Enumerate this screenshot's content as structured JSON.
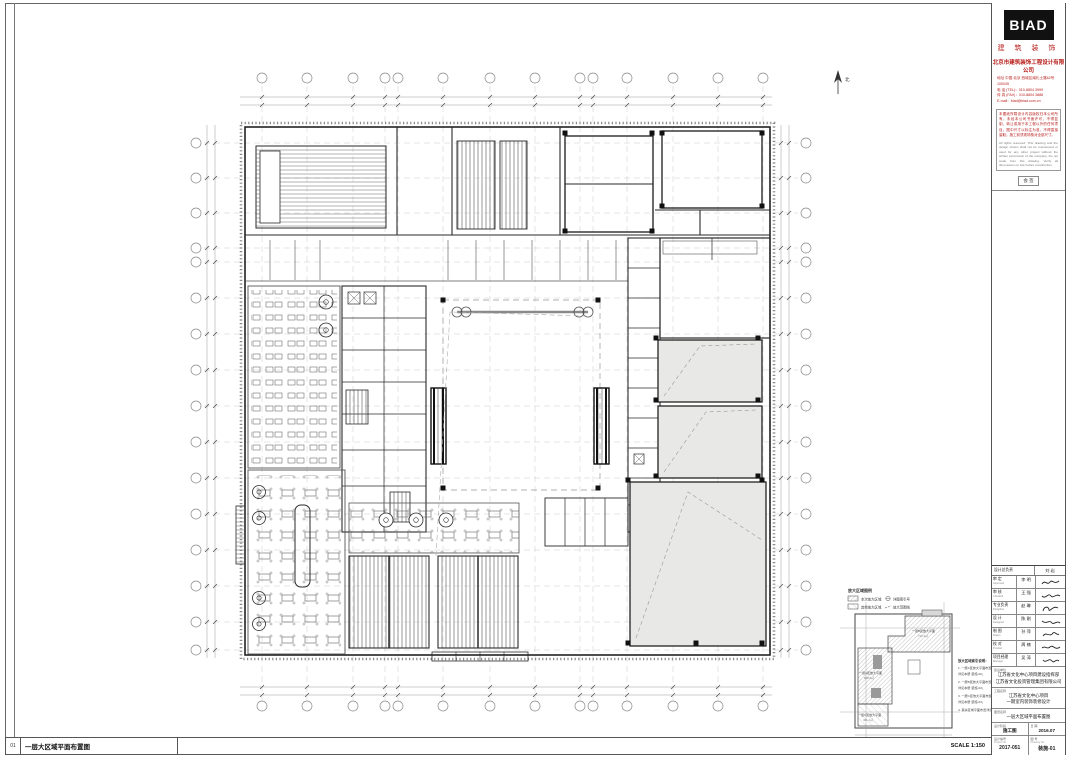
{
  "colors": {
    "accent_red": "#b8201d",
    "line": "#3f3f3f",
    "zone_fill": "#e8e8e6",
    "logo_bg": "#111111"
  },
  "brand": {
    "logo": "BIAD",
    "logo_sub": "建 筑 装 饰",
    "company": "北京市建筑装饰工程设计有限公司",
    "address_lines": [
      "地址 中国 北京 西城区南礼士路62号 100045",
      "电 话 (TEL)：010-8804 3999",
      "传 真 (FAX)：010-8804 3888",
      "E-mail：biad@biad.com.cn"
    ],
    "notes_cn": "本图纸所载设计内容版权归本公司所有，未经本公司书面许可，不得复制、转让或用于本工程以外的任何项目。图中尺寸以标注为准，不得直接量取；施工前须现场核对全部尺寸。",
    "notes_en": "All rights reserved. This drawing and the design shown shall not be reproduced or used for any other project without the written permission of the company. Do not scale from this drawing. Verify all dimensions on site before construction."
  },
  "sign": {
    "label": "会 签"
  },
  "titleblock": {
    "header": {
      "role": "设计总负责",
      "name": "刘 岩"
    },
    "rows": [
      {
        "role": "审 定",
        "en": "Approved",
        "name": "李 明"
      },
      {
        "role": "审 核",
        "en": "Checked",
        "name": "王 强"
      },
      {
        "role": "专业负责",
        "en": "Discipline",
        "name": "赵 琳"
      },
      {
        "role": "设 计",
        "en": "Designed",
        "name": "陈 刚"
      },
      {
        "role": "制 图",
        "en": "Drawn",
        "name": "孙 萍"
      },
      {
        "role": "校 对",
        "en": "Proofed",
        "name": "周 楠"
      },
      {
        "role": "项目经理",
        "en": "Manager",
        "name": "吴 涛"
      }
    ],
    "client": {
      "label": "建设单位",
      "lines": [
        "江苏省文化中心项目建设指挥部",
        "江苏省文化投资管理集团有限公司"
      ]
    },
    "project": {
      "label": "工程名称",
      "lines": [
        "江苏省文化中心项目",
        "一期室内装饰装修设计"
      ]
    },
    "drawing": {
      "label": "图纸名称",
      "lines": [
        "一层大区域平面布置图"
      ]
    },
    "meta": [
      {
        "label": "设计阶段",
        "value": "施工图"
      },
      {
        "label": "日 期",
        "value": "2016.07"
      }
    ],
    "numbers": [
      {
        "label": "设计编号",
        "en": "Project No.",
        "value": "2017-051"
      },
      {
        "label": "图 号",
        "en": "Drawing No.",
        "value": "装施-01"
      }
    ]
  },
  "keyplan": {
    "legend_title": "放大区域图例",
    "legend": [
      {
        "label": "本次放大区域",
        "symbol_label": "详图索引号"
      },
      {
        "label": "其他放大区域",
        "symbol_label": "放大范围线"
      }
    ],
    "zones": [
      {
        "label": "一层B区放大平面",
        "area": "772.3㎡"
      },
      {
        "label": "一层A区放大平面",
        "area": "658.6㎡"
      },
      {
        "label": "一层C区放大平面",
        "area": "401.2㎡"
      }
    ],
    "notes_title": "放大区域索引说明：",
    "notes": [
      "1. 一层A区放大平面布置图，",
      "   详见本册 装施-02；",
      "2. 一层B区放大平面布置图，",
      "   详见本册 装施-03；",
      "3. 一层C区放大平面布置图，",
      "   详见本册 装施-04；",
      "4. 其余区域平面布置详见各区放大图。"
    ],
    "axis_mark_left": "1-1",
    "axis_mark_right": "1-1"
  },
  "plan": {
    "north_label": "北"
  },
  "footer": {
    "index": "01",
    "title": "一层大区域平面布置图",
    "scale": "SCALE 1:150"
  }
}
